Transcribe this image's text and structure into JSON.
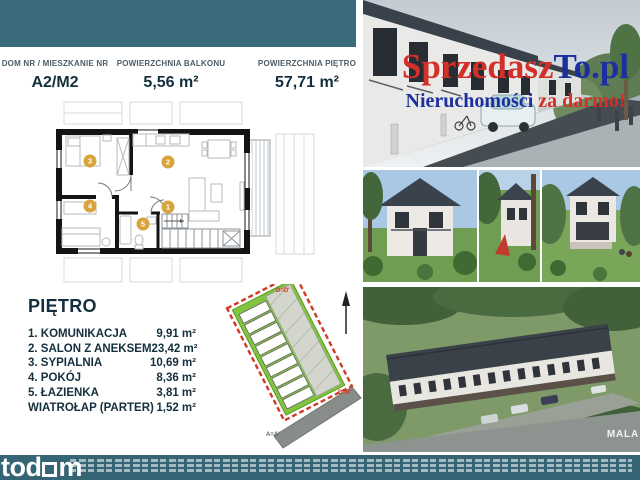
{
  "colors": {
    "teal": "#3a6b7c",
    "footer_teal": "#35657a",
    "gold": "#d9a43c",
    "navy": "#132f3d",
    "brand_red": "#d3302a",
    "brand_blue": "#1c2f9e",
    "plot_green": "#82c341",
    "boundary_red": "#d03a26"
  },
  "spec": {
    "columns": [
      {
        "label": "DOM NR / MIESZKANIE NR",
        "value": "A2/M2"
      },
      {
        "label": "POWIERZCHNIA BALKONU",
        "value": "5,56 m²"
      },
      {
        "label": "POWIERZCHNIA PIĘTRO",
        "value": "57,71 m²"
      }
    ]
  },
  "floor_plan": {
    "numbers": {
      "n1": "1",
      "n2": "2",
      "n3": "3",
      "n4": "4",
      "n5": "5"
    }
  },
  "rooms": {
    "heading": "PIĘTRO",
    "items": [
      {
        "name": "1. KOMUNIKACJA",
        "area": "9,91 m²"
      },
      {
        "name": "2. SALON Z ANEKSEM",
        "area": "23,42 m²"
      },
      {
        "name": "3. SYPIALNIA",
        "area": "10,69 m²"
      },
      {
        "name": "4. POKÓJ",
        "area": "8,36 m²"
      },
      {
        "name": "5. ŁAZIENKA",
        "area": "3,81 m²"
      },
      {
        "name": "WIATROŁAP (PARTER)",
        "area": "1,52 m²"
      }
    ]
  },
  "site_plan": {
    "label_top": "D=D'",
    "label_right": "B=B'",
    "label_bottom": "A=A'"
  },
  "watermark": {
    "line1_red": "Sprzedasz",
    "line1_blue": "To.pl",
    "line2_blue": "Nieruchomości",
    "line2_red": " za darmo!"
  },
  "aerial_photo": {
    "development_label": "MALA"
  },
  "footer": {
    "logo_part1": "tod",
    "logo_part2": "m"
  }
}
